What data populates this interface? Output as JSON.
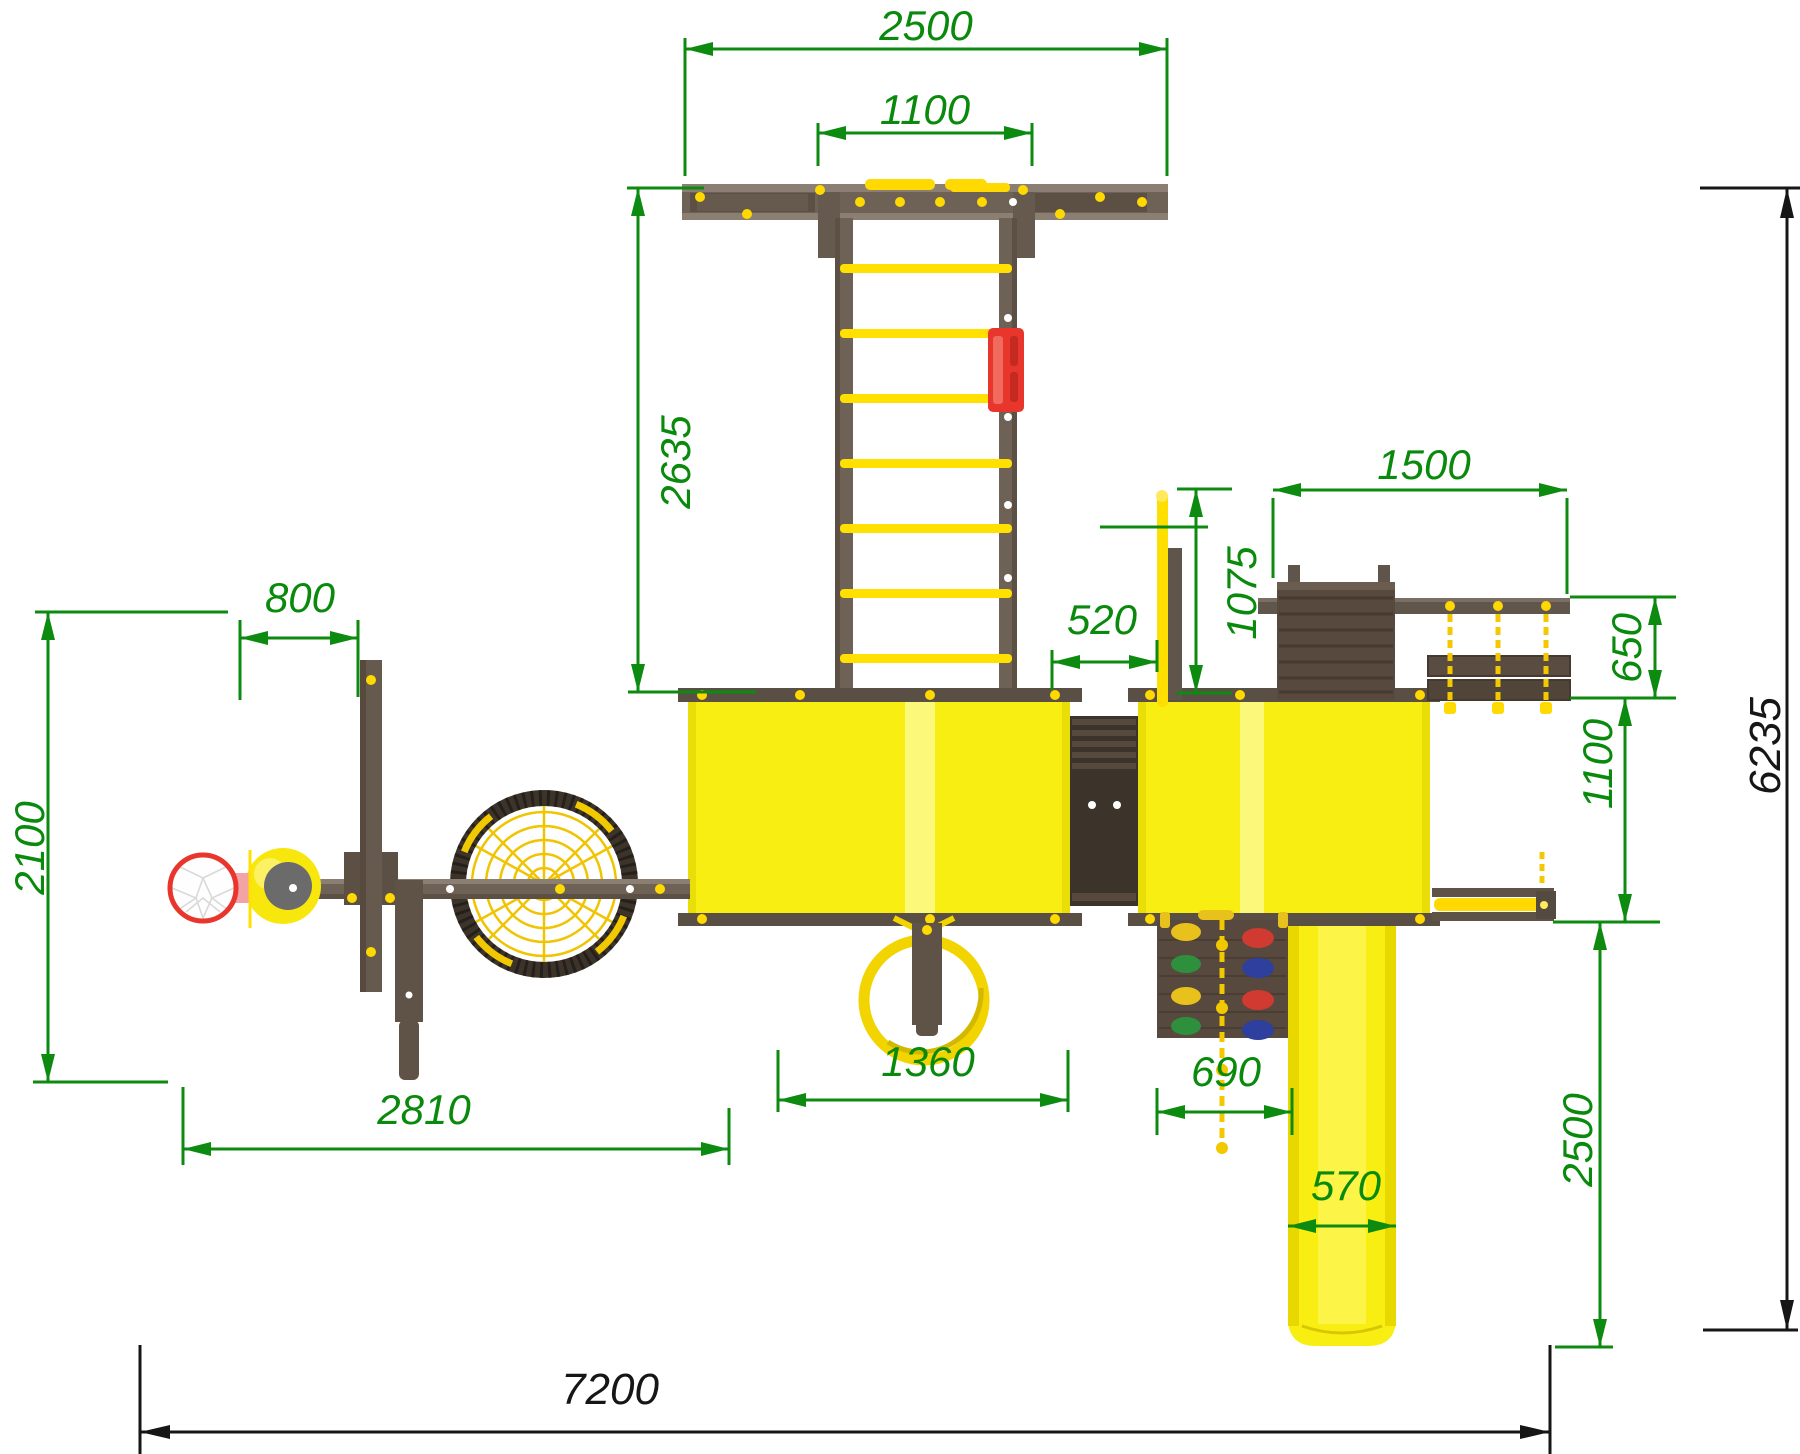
{
  "drawing": {
    "type": "playground-top-view-dimension-drawing",
    "colors": {
      "dim_green": "#0d8a10",
      "dim_black": "#161616",
      "wood": "#6e6256",
      "wood_light_rail": "#8a7f72",
      "wood_dark": "#57493d",
      "wood_deep": "#3c342b",
      "panel_yellow": "#f8ee12",
      "panel_stripe": "#fcf87a",
      "rung_yellow": "#ffe000",
      "rope_yellow": "#f2c800",
      "accent_red": "#e8362c",
      "bracket_pink": "#f2a3a3",
      "hold_yellow": "#e8c11c",
      "hold_red": "#d03a30",
      "hold_green": "#2e8f3c",
      "hold_blue": "#2e3f9e"
    },
    "dims": {
      "d2500_top": "2500",
      "d1100_top": "1100",
      "d2635": "2635",
      "d1500": "1500",
      "d1075": "1075",
      "d520": "520",
      "d650": "650",
      "d1100_right": "1100",
      "d800": "800",
      "d2100": "2100",
      "d2810": "2810",
      "d1360": "1360",
      "d690": "690",
      "d570": "570",
      "d2500_right": "2500",
      "d6235": "6235",
      "d7200": "7200"
    }
  }
}
